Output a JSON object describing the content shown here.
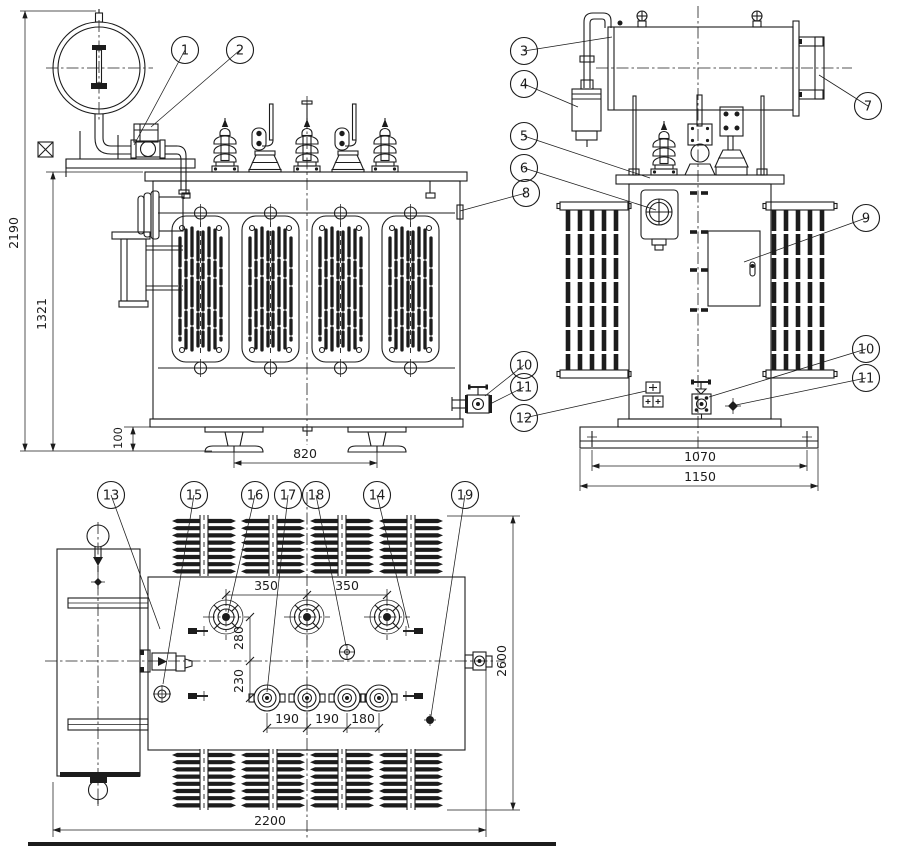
{
  "drawing": {
    "colors": {
      "line": "#1c1c1c",
      "background": "#ffffff"
    },
    "callouts": {
      "c1": "1",
      "c2": "2",
      "c3": "3",
      "c4": "4",
      "c5": "5",
      "c6": "6",
      "c7": "7",
      "c8": "8",
      "c9": "9",
      "c10": "10",
      "c11": "11",
      "c12": "12",
      "c13": "13",
      "c14": "14",
      "c15": "15",
      "c16": "16",
      "c17": "17",
      "c18": "18",
      "c19": "19"
    },
    "dimensions": {
      "front": {
        "overall_height": "2190",
        "tank_height": "1321",
        "wheel_height": "100",
        "wheel_spacing": "820"
      },
      "side": {
        "base_hole_spacing": "1070",
        "base_width": "1150"
      },
      "plan": {
        "hv_pitch_a": "350",
        "hv_pitch_b": "350",
        "hv_row_offset": "280",
        "lv_row_offset": "230",
        "lv_pitch_a": "190",
        "lv_pitch_b": "190",
        "lv_pitch_c": "180",
        "overall_length": "2200",
        "overall_depth": "2600"
      }
    }
  }
}
